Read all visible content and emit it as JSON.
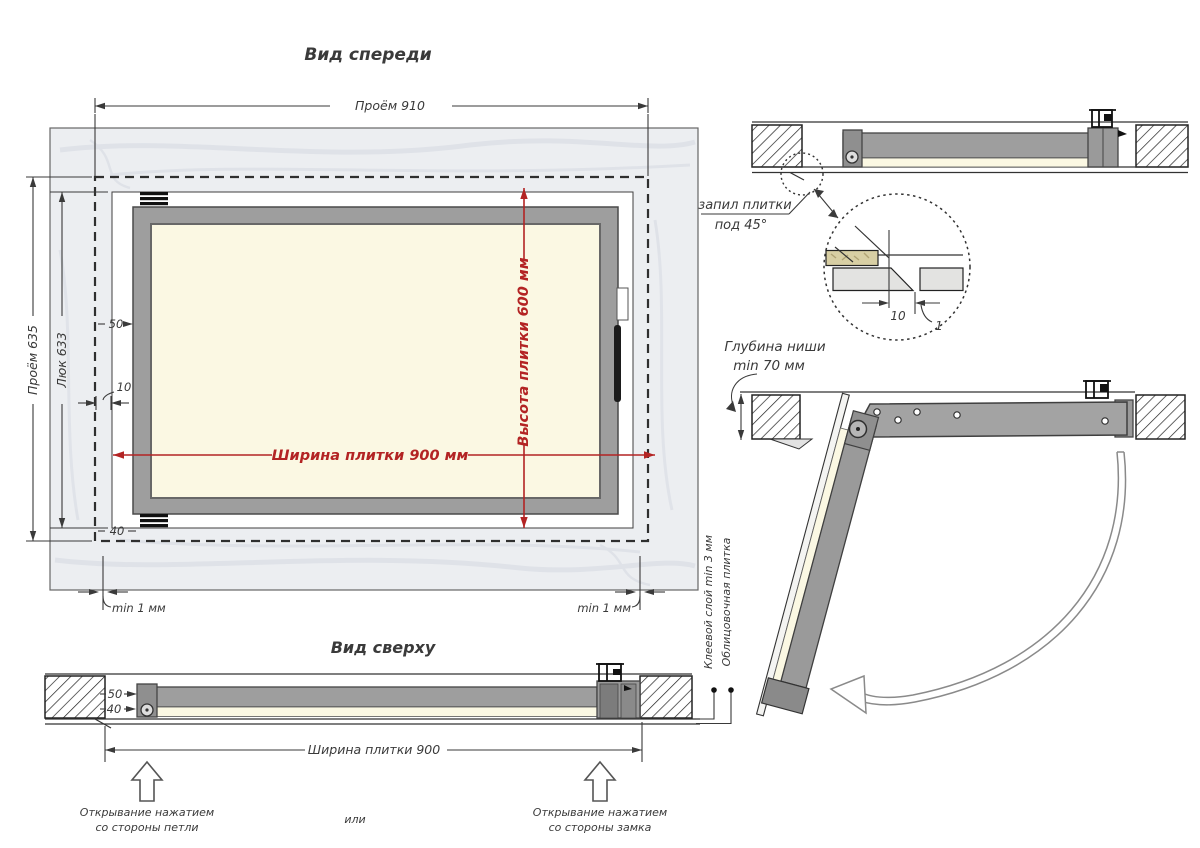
{
  "colors": {
    "dimension_red": "#b32424",
    "frame_gray": "#9e9e9e",
    "tile_cream": "#fbf8e3",
    "marble_wall": "#eceef1",
    "line_dark": "#3a3a3a"
  },
  "front_view": {
    "title": "Вид спереди",
    "opening_width": "Проём 910",
    "opening_height": "Проём 635",
    "hatch_height": "Люк 633",
    "offset_50": "50",
    "offset_10": "10",
    "offset_40": "40",
    "tile_width": "Ширина плитки 900 мм",
    "tile_height": "Высота плитки 600 мм",
    "gap_left": "min 1 мм",
    "gap_right": "min 1 мм"
  },
  "top_view": {
    "title": "Вид сверху",
    "offset_50": "50",
    "offset_40": "40",
    "tile_width": "Ширина плитки 900",
    "glue_layer": "Клеевой слой min 3 мм",
    "facing_tile": "Облицовочная плитка",
    "open_hinge_line1": "Открывание нажатием",
    "open_hinge_line2": "со стороны петли",
    "or_label": "или",
    "open_lock_line1": "Открывание нажатием",
    "open_lock_line2": "со стороны замка"
  },
  "section_view": {
    "tile_cut_line1": "запил плитки",
    "tile_cut_line2": "под 45°",
    "detail_10": "10",
    "detail_1": "1"
  },
  "open_view": {
    "niche_depth_line1": "Глубина ниши",
    "niche_depth_line2": "min 70 мм"
  }
}
